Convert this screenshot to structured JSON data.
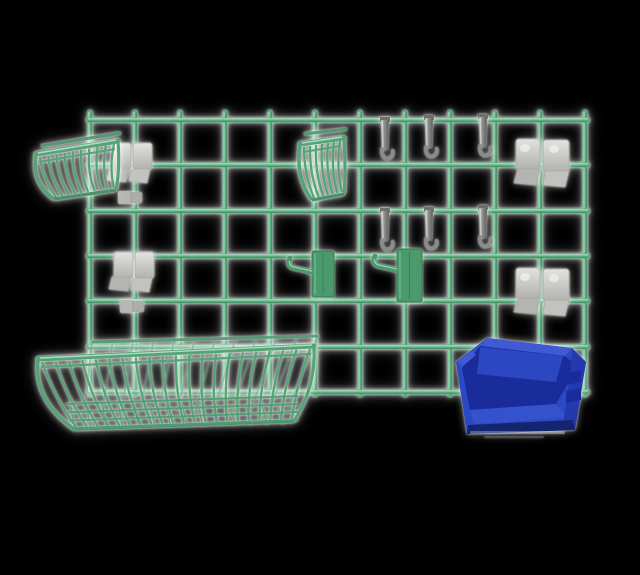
{
  "meta": {
    "description": "Product image: green wire grid wall organizer with accessories on black background",
    "background": "#000000"
  },
  "palette": {
    "bg": "#000000",
    "gridGreen": "#5aab7c",
    "gridLight": "#b2e0c6",
    "gridDark": "#3c8a60",
    "basketGreen": "#55a376",
    "basketLight": "#b9e4cc",
    "basketDim": "#47946a",
    "greenHook": "#4a9a6c",
    "greenEdge": "#2f7a52",
    "hookLight": "#d6d6d2",
    "hookMid": "#8b8b88",
    "hookDark": "#6f6f6c",
    "clipLight": "#d5d5d1",
    "clipMid": "#c2c2be",
    "clipDark": "#a6a6a2",
    "clipShade": "#b4b4b0",
    "binMain": "#2b49c4",
    "binLight": "#4059d4",
    "binLight2": "#3352cc",
    "binMid": "#2c47c2",
    "binDark": "#1a2c9c",
    "binSide": "#2439b0",
    "binDeep": "#14246e"
  },
  "scene": {
    "items": [
      {
        "name": "wire-grid-panel",
        "color_key": "gridGreen"
      },
      {
        "name": "small-wire-basket-left",
        "color_key": "basketGreen"
      },
      {
        "name": "small-wire-basket-center",
        "color_key": "basketGreen"
      },
      {
        "name": "utility-hooks-gray",
        "count": 6,
        "color_key": "hookMid"
      },
      {
        "name": "mounting-clip-clusters",
        "count": 4,
        "color_key": "clipMid"
      },
      {
        "name": "green-bracket-hooks",
        "count": 2,
        "color_key": "greenHook"
      },
      {
        "name": "large-wire-basket",
        "color_key": "basketGreen"
      },
      {
        "name": "blue-stacking-bin",
        "color_key": "binMain"
      }
    ],
    "grid": {
      "x0": 90,
      "pitch": 45,
      "verticalCount": 12,
      "yTop": 110,
      "yBottom": 397,
      "rails": [
        120,
        165,
        211,
        256,
        301,
        347,
        392
      ],
      "railX1": 86,
      "railX2": 590,
      "thickness": 5
    },
    "grayHooks": [
      {
        "x": 385,
        "y": 117
      },
      {
        "x": 429,
        "y": 115
      },
      {
        "x": 483,
        "y": 114
      },
      {
        "x": 385,
        "y": 208
      },
      {
        "x": 429,
        "y": 207
      },
      {
        "x": 483,
        "y": 205
      }
    ],
    "clipClusters": [
      {
        "type": "small",
        "x": 112,
        "y": 143,
        "bits": true
      },
      {
        "type": "small",
        "x": 114,
        "y": 252,
        "bits": true
      },
      {
        "type": "large",
        "x": 516,
        "y": 139,
        "bits": false
      },
      {
        "type": "large",
        "x": 516,
        "y": 268,
        "bits": false
      }
    ],
    "greenHooks": [
      {
        "x": 312,
        "y": 251,
        "w": 22,
        "h": 46
      },
      {
        "x": 397,
        "y": 249,
        "w": 25,
        "h": 53
      }
    ],
    "smallBaskets": [
      {
        "rimBack": [
          41,
          146,
          121,
          133
        ],
        "rimFront": [
          36,
          154,
          118,
          141
        ],
        "bottom": [
          54,
          199,
          116,
          190
        ],
        "slats": 10
      },
      {
        "rimBack": [
          304,
          134,
          347,
          129
        ],
        "rimFront": [
          300,
          144,
          344,
          138
        ],
        "bottom": [
          312,
          200,
          344,
          194
        ],
        "slats": 7
      }
    ],
    "largeBasket": {
      "rimBack": [
        92,
        342,
        318,
        336
      ],
      "rimFront": [
        38,
        359,
        314,
        346
      ],
      "bottom": [
        74,
        429,
        294,
        421
      ],
      "slats": 21,
      "backSlats": 12,
      "meshRows": 4,
      "meshTicks": 14
    },
    "bin": {
      "silhouette": "456,362 487,338 572,348 586,362 575,430 467,434",
      "topBack": "487,338 572,348 565,356 480,346",
      "topLeftEdge": "456,362 487,338 480,346 462,368",
      "interior": "462,368 480,346 565,356 578,367 556,404 470,410",
      "innerWall": "480,347 563,356 556,382 477,374",
      "frontLip": "470,410 556,404 568,418 474,424",
      "rightFace": "572,348 586,362 575,430 563,424 571,370",
      "notch1": "566,373 581,370 581,382 566,385",
      "notch2": "566,391 581,388 581,400 566,403",
      "bottomBand": "467,434 575,430 573,420 468,425",
      "cornerNotch": "458,361 472,351 476,355 463,366"
    }
  }
}
